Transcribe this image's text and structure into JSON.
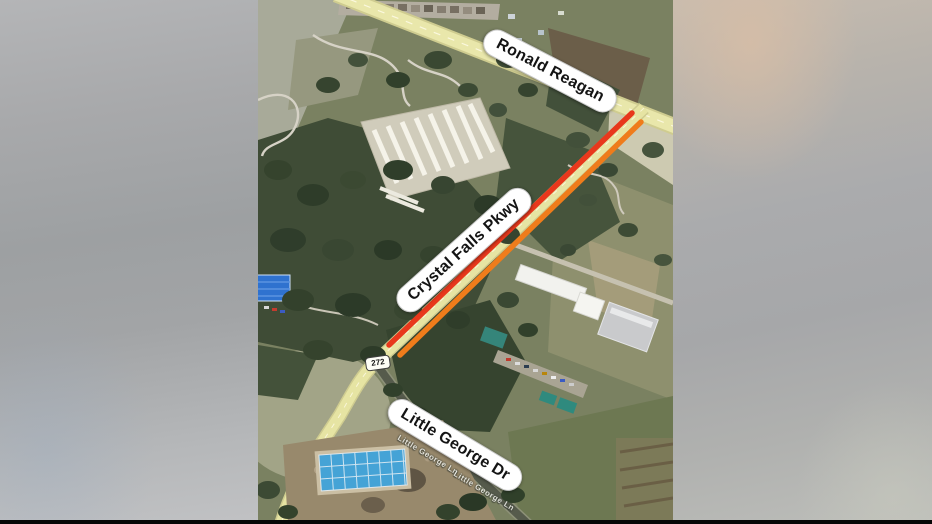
{
  "map": {
    "labels": {
      "ronald_reagan": "Ronald Reagan",
      "crystal_falls_pkwy": "Crystal Falls Pkwy",
      "little_george_dr": "Little George Dr"
    },
    "route_shield": {
      "number": "272"
    },
    "street_names": {
      "segment_1": "Little George Ln",
      "segment_2": "Little George Ln"
    },
    "highlight": {
      "closure_color_red": "#e8381c",
      "closure_color_orange": "#ef7c1b",
      "road_color": "#e6e4a3"
    }
  }
}
